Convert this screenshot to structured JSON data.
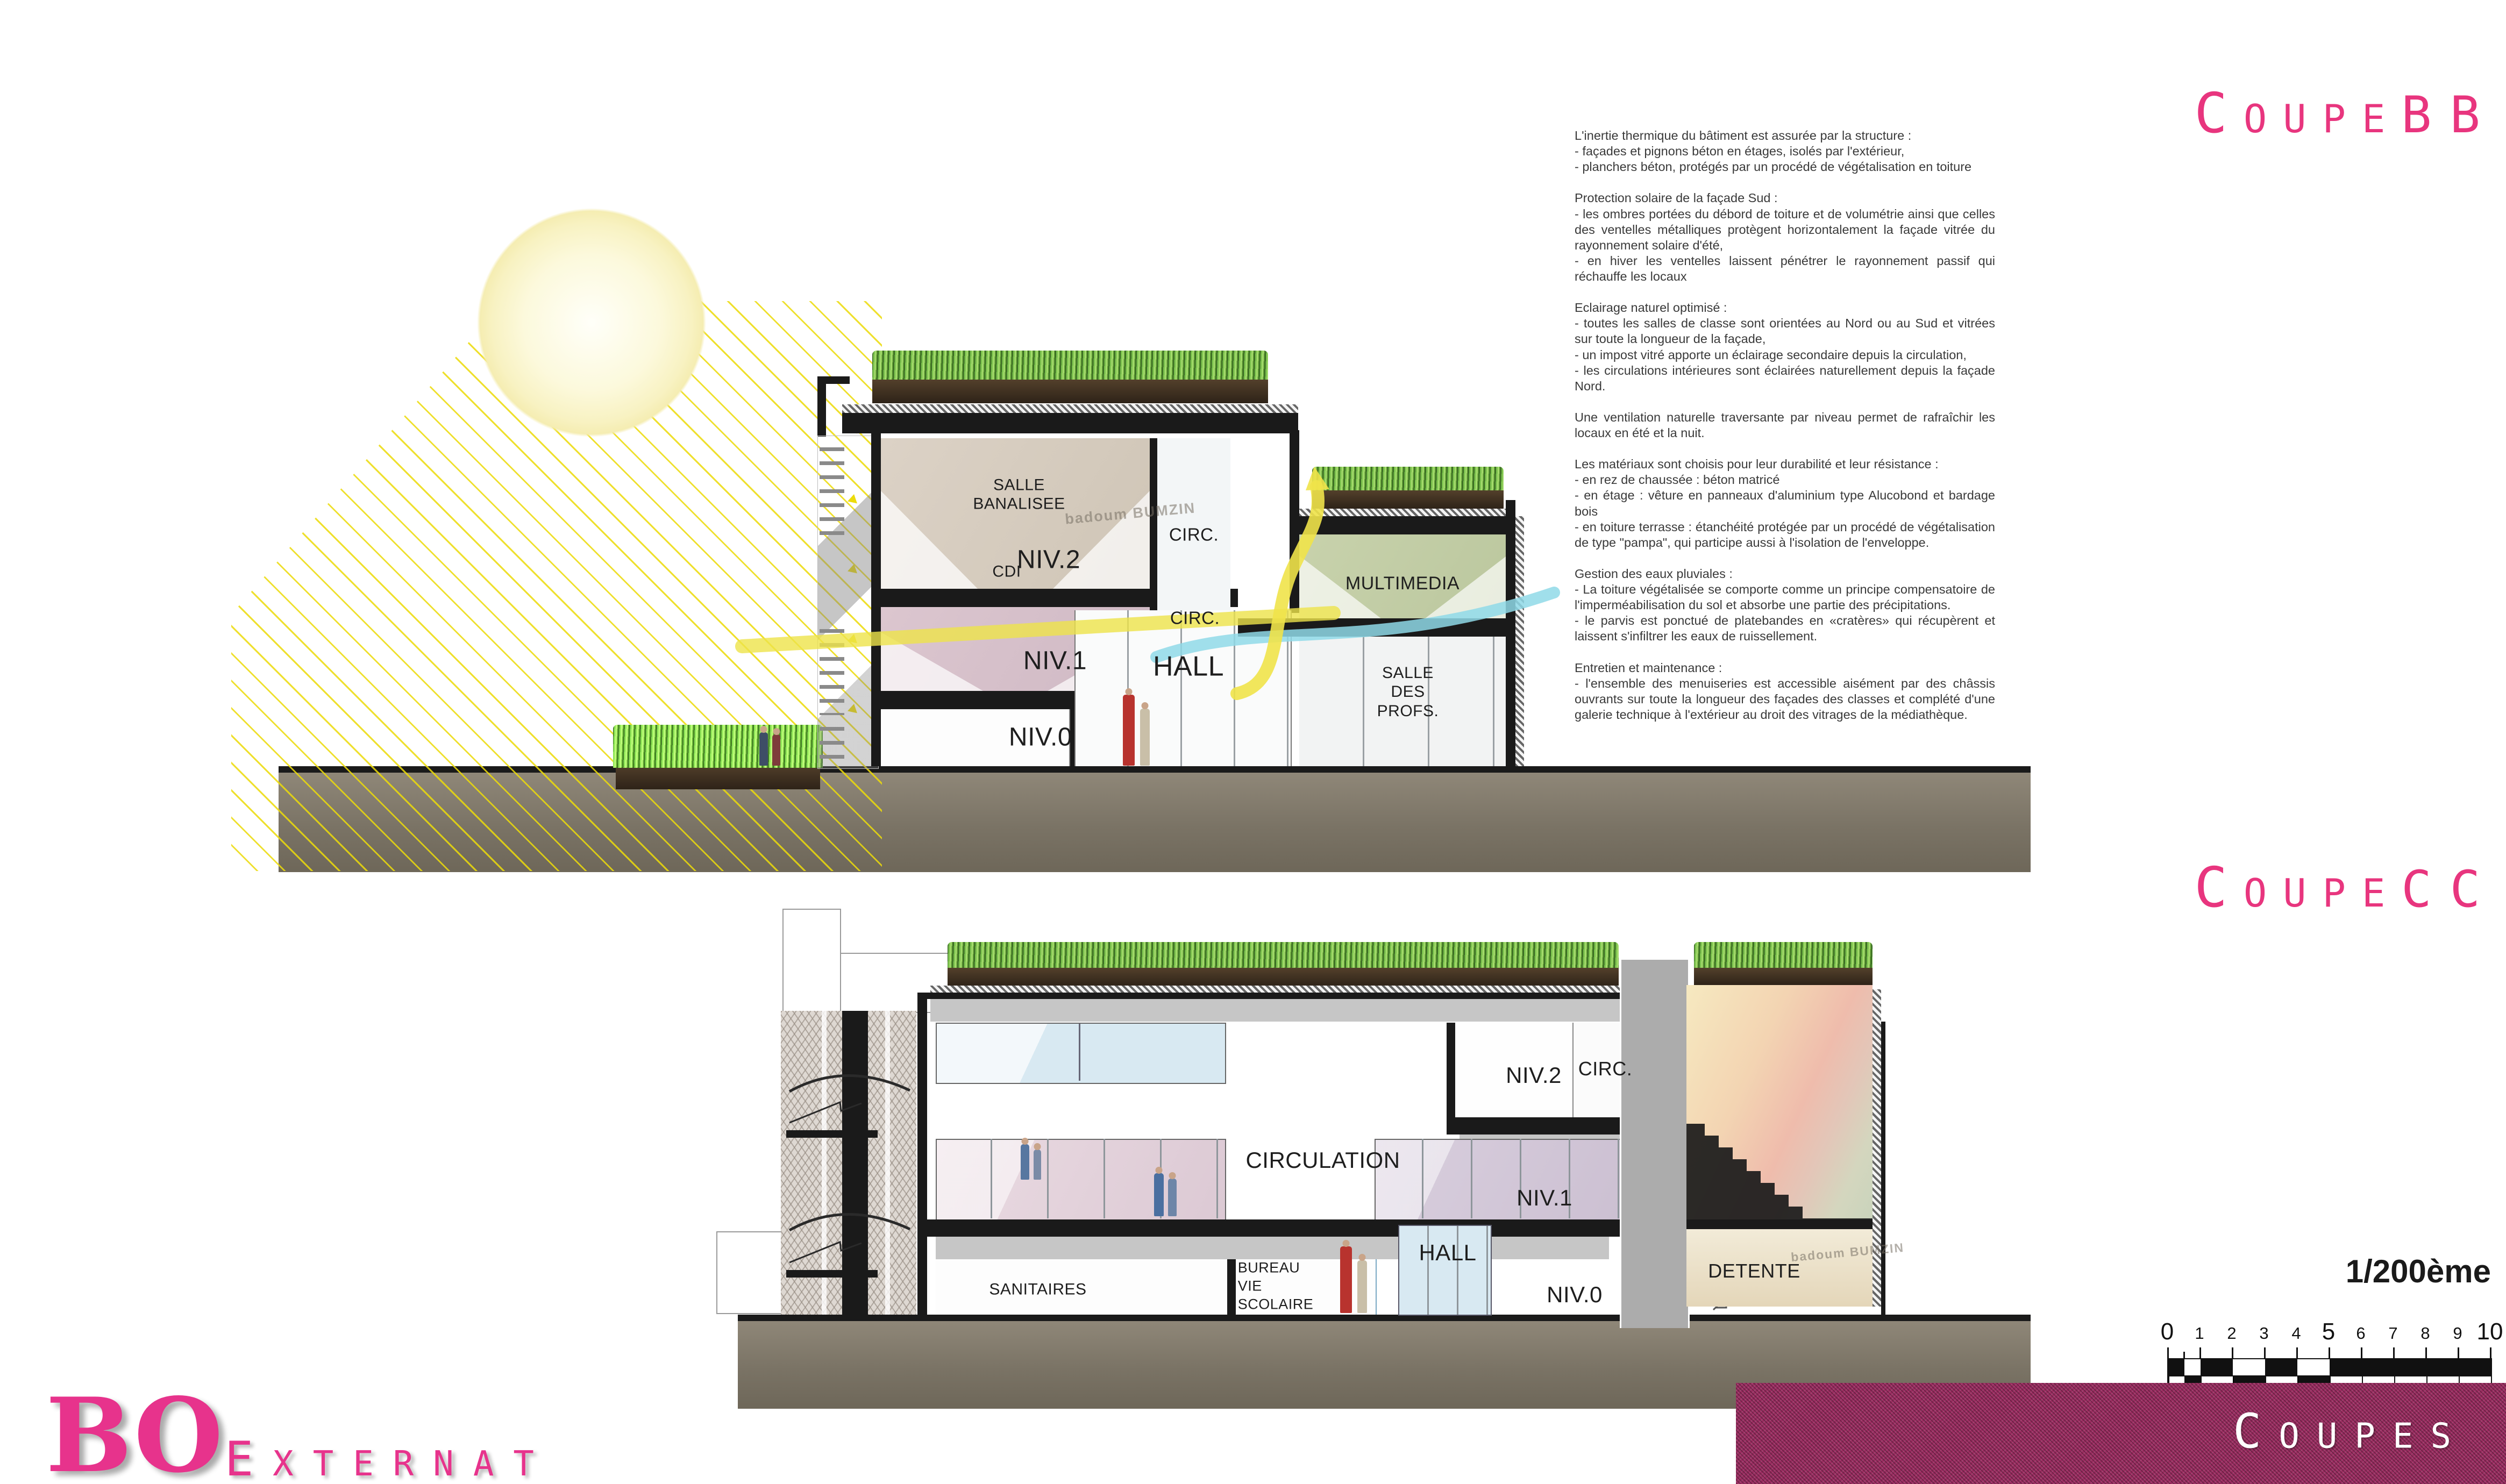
{
  "titles": {
    "bb_word": "Coupe",
    "bb_suffix": "BB",
    "cc_word": "Coupe",
    "cc_suffix": "CC"
  },
  "notes": {
    "paragraphs": [
      "L'inertie thermique du bâtiment est assurée par la structure :\n- façades et pignons béton en étages, isolés par l'extérieur,\n- planchers béton, protégés par un procédé de végétalisation en toiture",
      "Protection solaire de la façade Sud :\n- les ombres portées du débord de toiture et de volumétrie ainsi que celles des ventelles métalliques protègent horizontalement la façade vitrée du rayonnement solaire d'été,\n- en hiver les ventelles laissent pénétrer le rayonnement passif qui réchauffe les locaux",
      "Eclairage naturel optimisé :\n- toutes les salles de classe sont orientées au Nord ou au Sud et vitrées sur toute la longueur de la façade,\n- un impost vitré apporte un éclairage secondaire depuis la circulation,\n- les circulations intérieures sont éclairées naturellement depuis la façade Nord.",
      "Une ventilation naturelle traversante par niveau permet de rafraîchir les locaux en été et la nuit.",
      "Les matériaux sont choisis pour leur durabilité et leur résistance :\n- en rez de chaussée : béton matricé\n- en étage : vêture en panneaux d'aluminium type Alucobond et bardage bois\n- en toiture terrasse : étanchéité protégée par un procédé de végétalisation de type \"pampa\", qui participe aussi à l'isolation de l'enveloppe.",
      "Gestion des eaux pluviales :\n- La toiture végétalisée se comporte comme un principe compensatoire de l'imperméabilisation du sol et absorbe une partie des précipitations.\n- le parvis est ponctué de platebandes en «cratères» qui récupèrent et laissent s'infiltrer les eaux de ruissellement.",
      "Entretien et maintenance :\n- l'ensemble des menuiseries est accessible aisément par des châssis ouvrants sur toute la longueur des façades des classes et complété d'une galerie technique à l'extérieur au droit des vitrages de la médiathèque."
    ]
  },
  "section_bb": {
    "labels": {
      "salle_banalisee": "SALLE\nBANALISEE",
      "niv2": "NIV.2",
      "circ_upper": "CIRC.",
      "cdi": "CDI",
      "niv1": "NIV.1",
      "circ_lower": "CIRC.",
      "multimedia": "MULTIMEDIA",
      "hall": "HALL",
      "niv0": "NIV.0",
      "salle_des_profs": "SALLE\nDES\nPROFS."
    }
  },
  "section_cc": {
    "labels": {
      "niv2": "NIV.2",
      "circ": "CIRC.",
      "circulation": "CIRCULATION",
      "niv1": "NIV.1",
      "sanitaires": "SANITAIRES",
      "bureau_vie_scolaire": "BUREAU\nVIE\nSCOLAIRE",
      "hall": "HALL",
      "niv0": "NIV.0",
      "detente": "DETENTE"
    }
  },
  "photo_graffiti": "badoum BUMZIN",
  "scalebar": {
    "ratio_label": "1/200ème",
    "numbers": [
      "0",
      "1",
      "2",
      "3",
      "4",
      "5",
      "6",
      "7",
      "8",
      "9",
      "10"
    ]
  },
  "footer": {
    "logo": "BO",
    "project_word": "Externat",
    "sheet_word": "Coupes"
  },
  "colors": {
    "accent_magenta": "#E8357E",
    "panel_magenta": "#9B2D61",
    "ray_yellow": "#ECDB0A",
    "grass_green": "#7CC24E",
    "ground_taupe": "#7A7365",
    "soil_brown": "#3E2F22"
  }
}
